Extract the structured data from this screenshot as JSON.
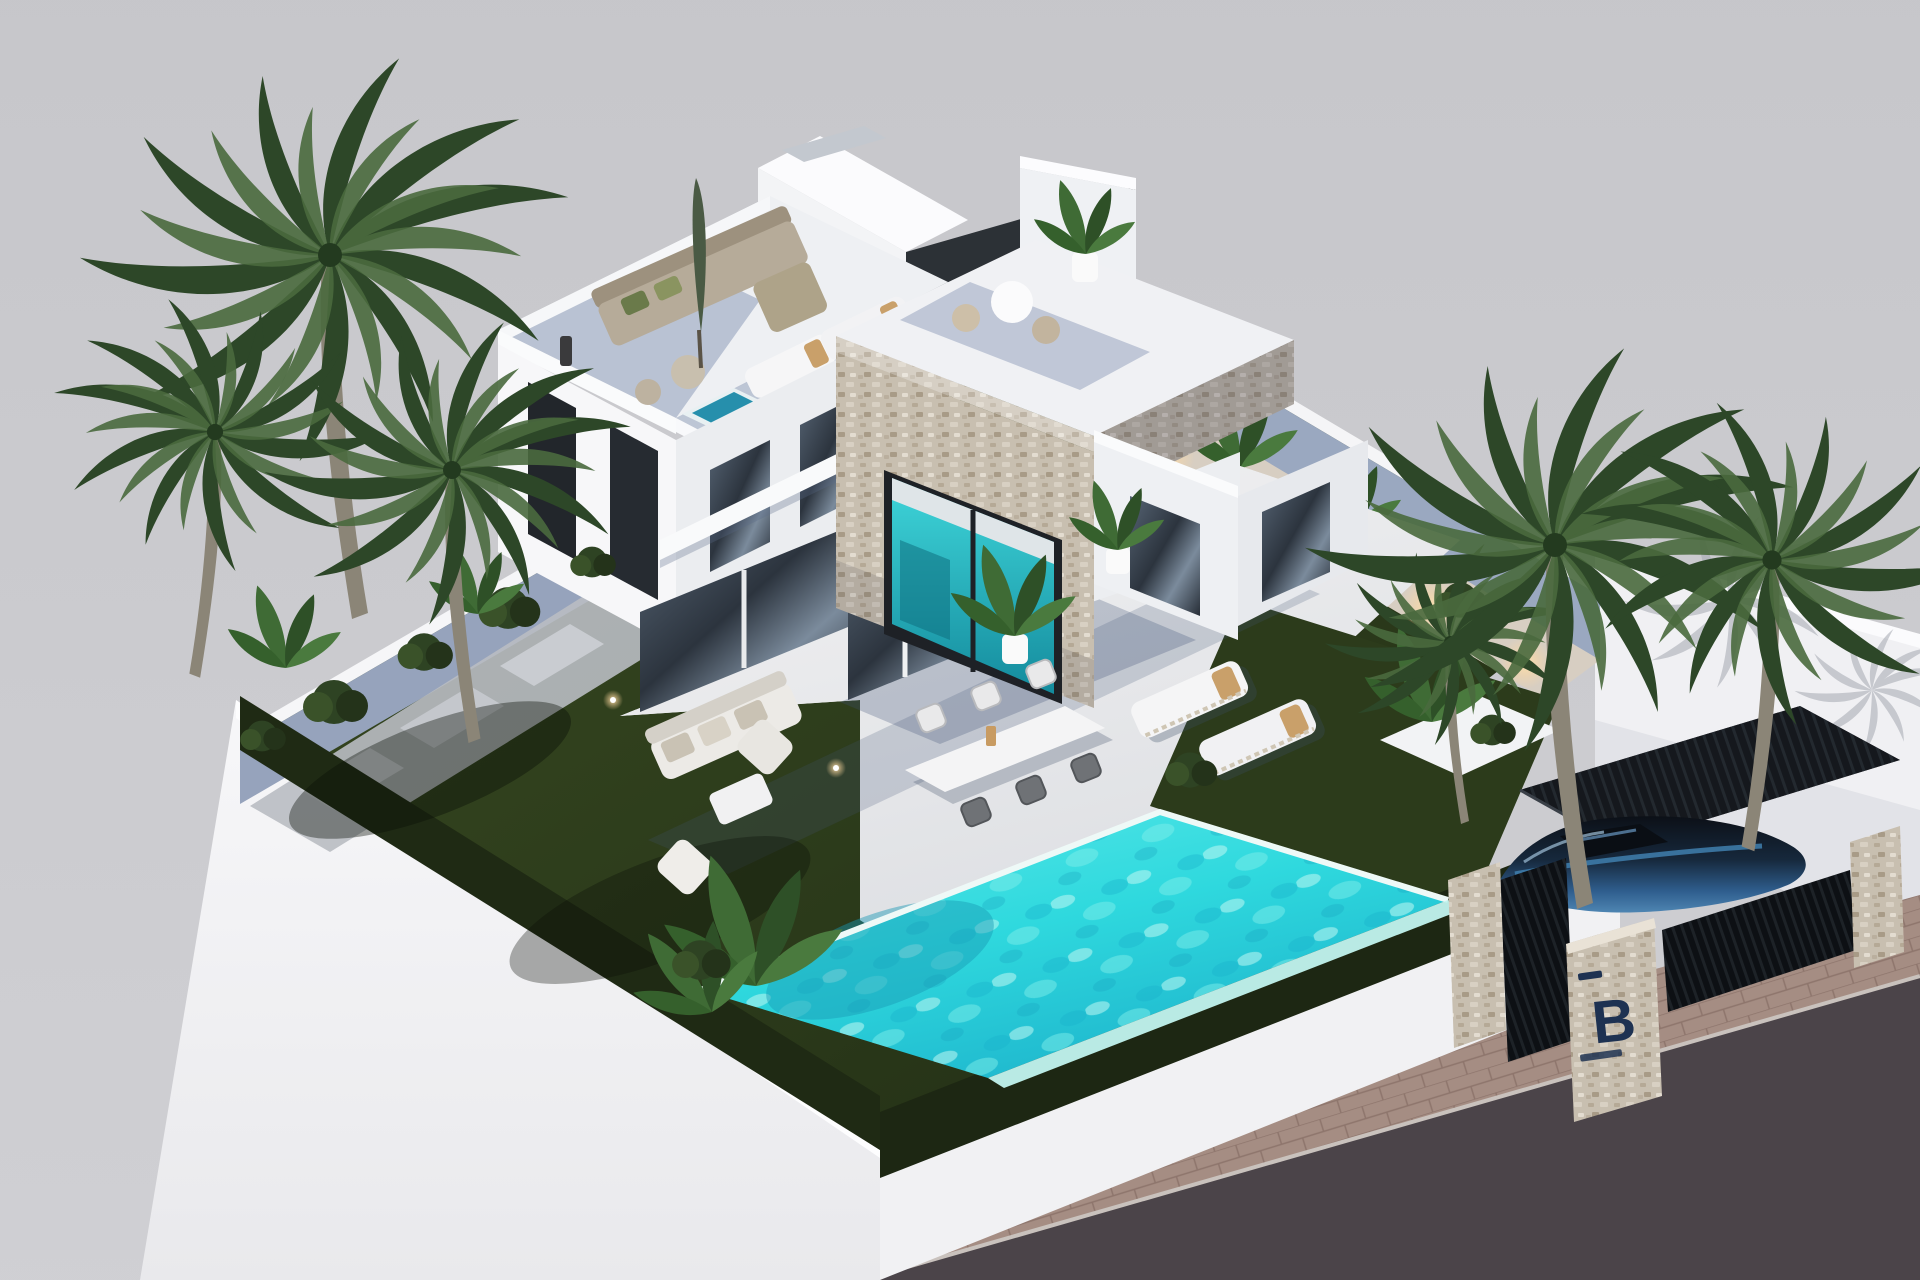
{
  "scene": {
    "title": "Aerial 3D render of modern white villa with pool and palm garden",
    "gate_sign": {
      "letter": "B"
    },
    "colors": {
      "background": "#c9c9cd",
      "road": "#4b4449",
      "sidewalk": "#a58d83",
      "wall_white": "#f4f4f6",
      "wall_inner_shadow": "#9aa8c0",
      "lawn": "#2c3b1b",
      "hedge": "#1f2a14",
      "patio": "#ececee",
      "gravel": "#d7cec2",
      "pool_water": "#35dde0",
      "pool_light": "#8ff0ec",
      "pool_deep": "#1898b4",
      "plunge_pool": "#2fc4d6",
      "stone_cladding": "#c8bfb0",
      "window_glass": "#22262b",
      "terrace_shadow": "#8d9cb8",
      "umbrella_green": "#4a5a44",
      "cushion_tan": "#c9a06a",
      "sofa_fabric": "#b6ab99",
      "palm_leaf": "#466339",
      "palm_leaf_dark": "#2d4728",
      "palm_trunk": "#8b8577",
      "bush_green": "#2e4323",
      "car_blue": "#3f7fae",
      "car_dark": "#0d1118",
      "carport_roof": "#14171c",
      "uplight_warm": "#ffd9a0",
      "logo_navy": "#1e3252",
      "white_furniture": "#f4f4f5"
    },
    "objects": [
      "villa-main-volume",
      "stone-clad-cube",
      "roof-stair-bulkhead",
      "rooftop-lounge-terrace",
      "rooftop-sun-deck",
      "rooftop-plunge-pool",
      "cube-roof-terrace",
      "swimming-pool",
      "infinity-edge",
      "lawn-garden",
      "central-patio",
      "outdoor-dining-set",
      "sun-loungers",
      "garden-lounge-set",
      "perimeter-wall",
      "gravel-path-uplights",
      "palm-trees",
      "banana-plants",
      "boundary-hedge",
      "carport",
      "parked-car",
      "entrance-gate",
      "gate-pillar-with-logo",
      "sidewalk",
      "street"
    ]
  }
}
